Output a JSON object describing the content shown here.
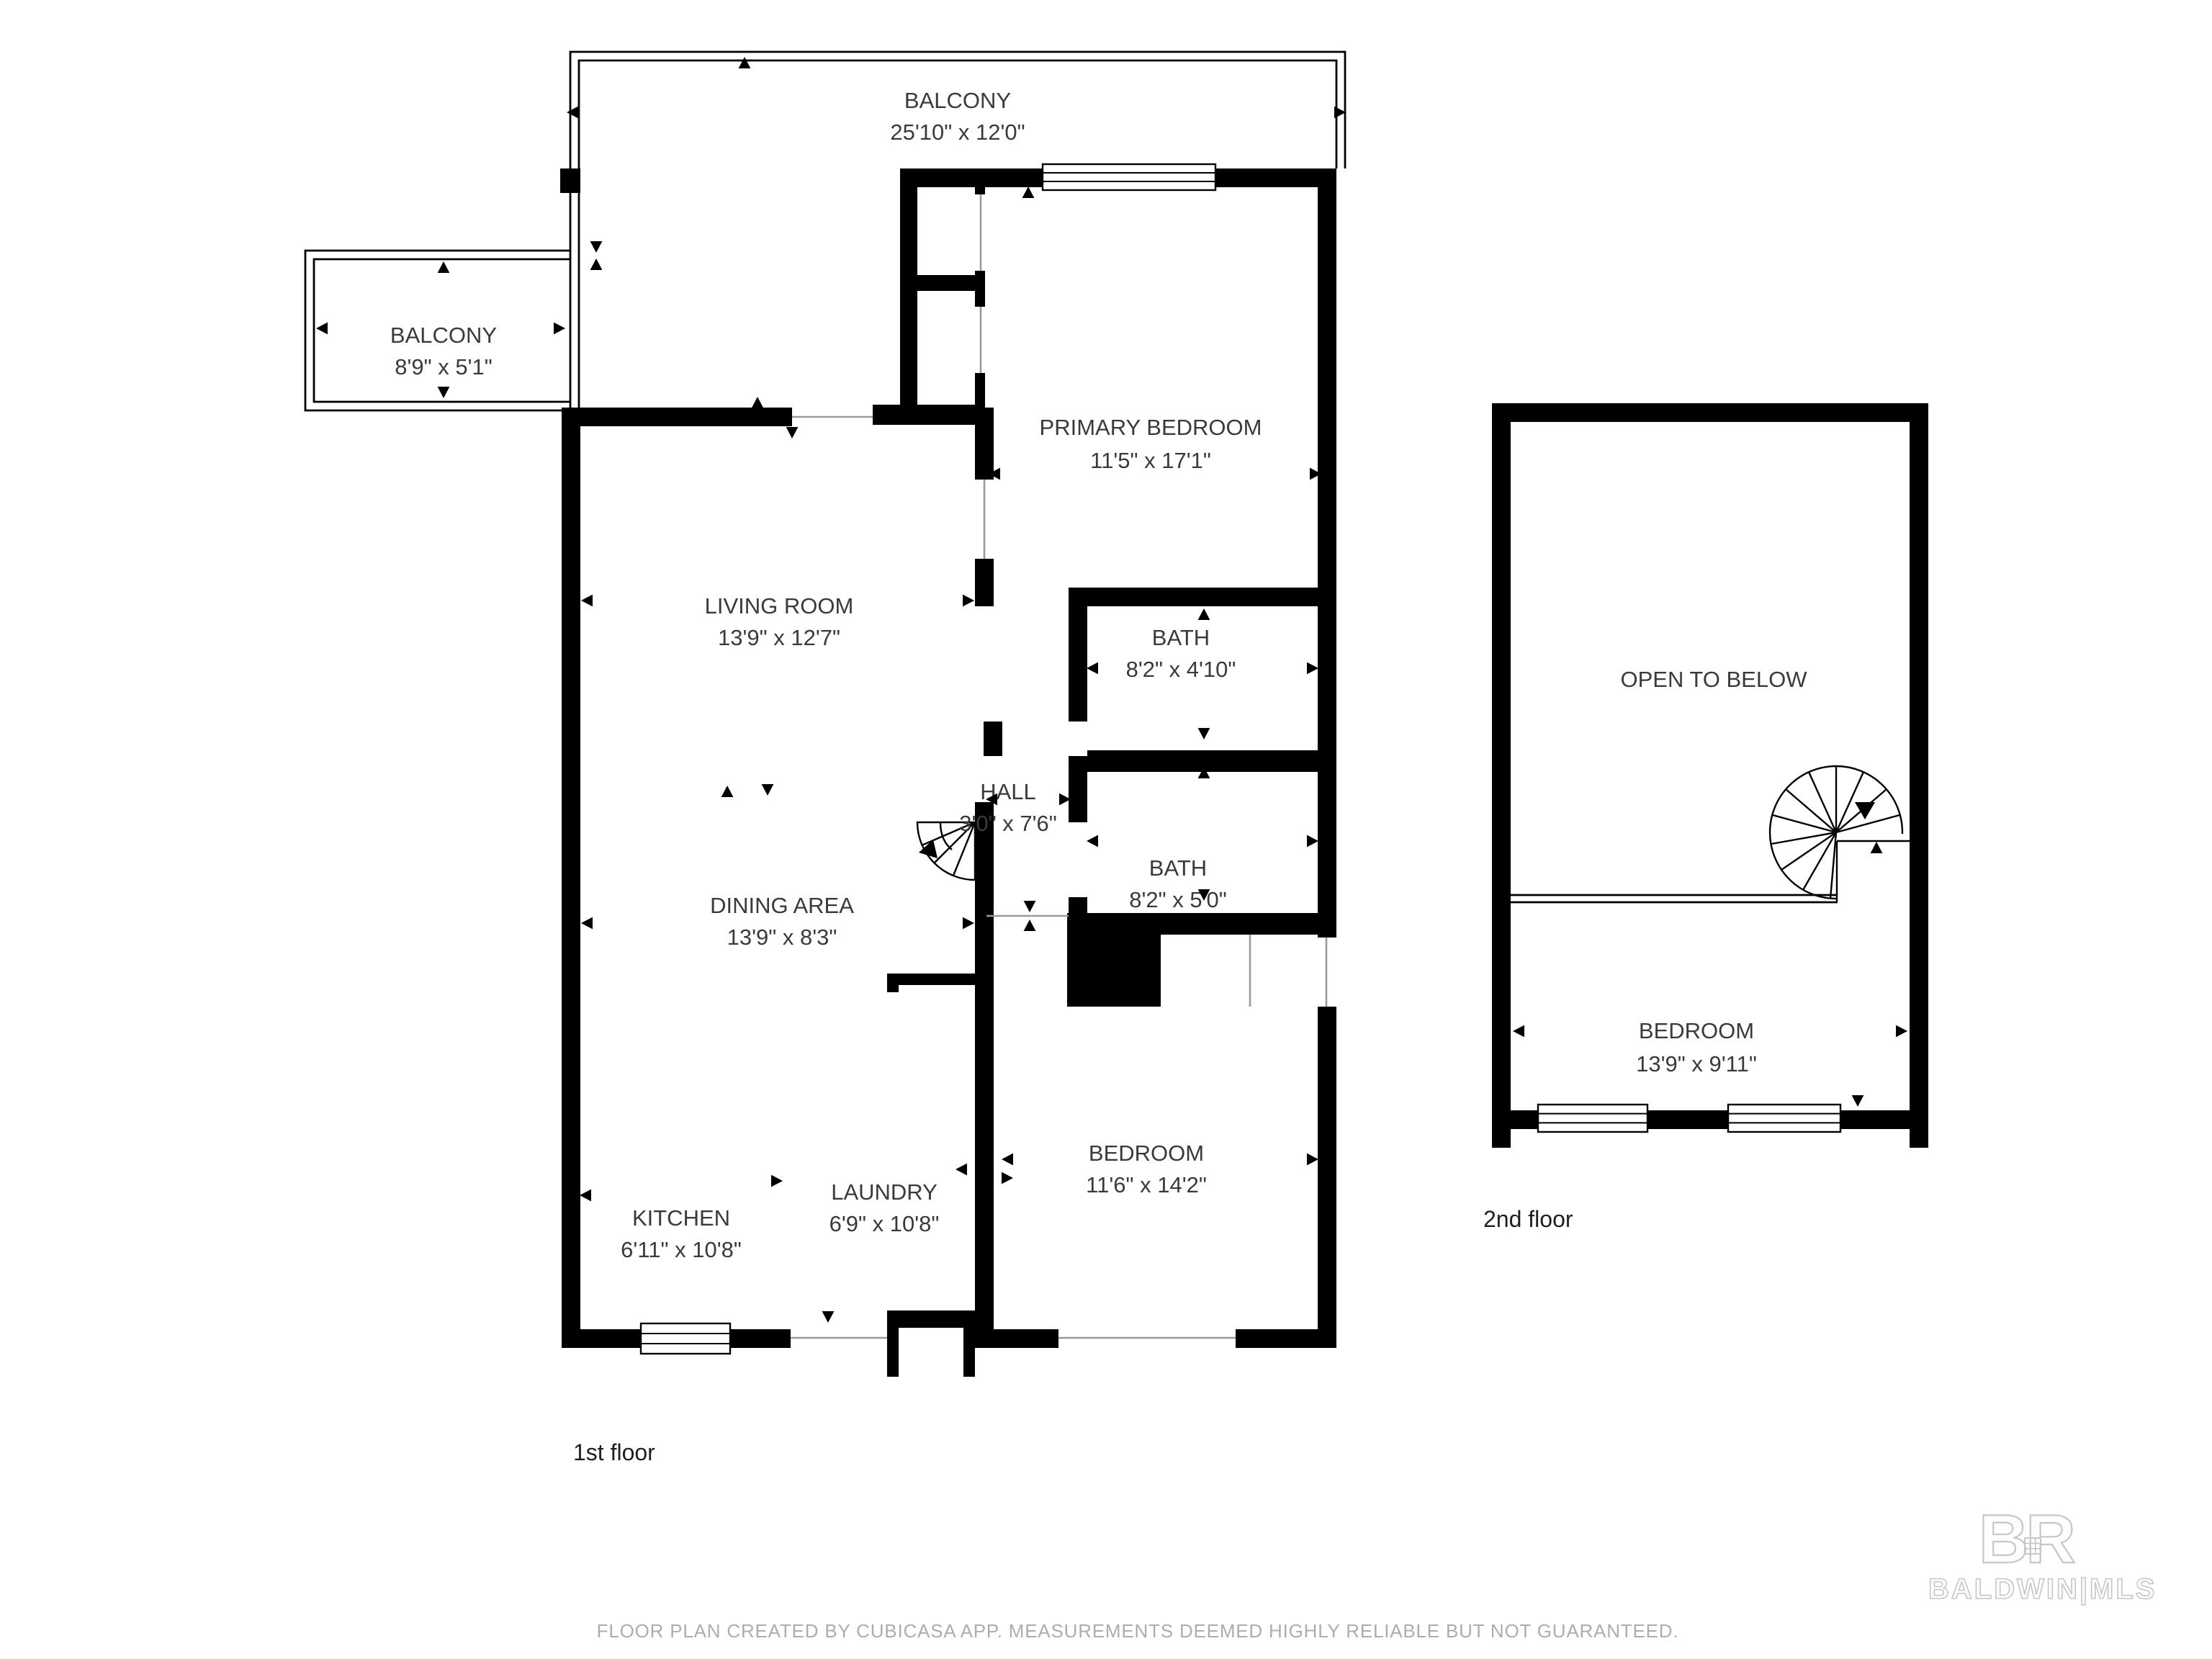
{
  "floors": [
    {
      "label": "1st floor",
      "rooms": [
        {
          "name": "BALCONY",
          "dims": "25'10\" x 12'0\""
        },
        {
          "name": "BALCONY",
          "dims": "8'9\" x 5'1\""
        },
        {
          "name": "PRIMARY BEDROOM",
          "dims": "11'5\" x 17'1\""
        },
        {
          "name": "LIVING ROOM",
          "dims": "13'9\" x 12'7\""
        },
        {
          "name": "BATH",
          "dims": "8'2\" x 4'10\""
        },
        {
          "name": "HALL",
          "dims": "3'0\" x 7'6\""
        },
        {
          "name": "BATH",
          "dims": "8'2\" x 5'0\""
        },
        {
          "name": "DINING AREA",
          "dims": "13'9\" x 8'3\""
        },
        {
          "name": "KITCHEN",
          "dims": "6'11\" x 10'8\""
        },
        {
          "name": "LAUNDRY",
          "dims": "6'9\" x 10'8\""
        },
        {
          "name": "BEDROOM",
          "dims": "11'6\" x 14'2\""
        }
      ]
    },
    {
      "label": "2nd floor",
      "rooms": [
        {
          "name": "OPEN TO BELOW"
        },
        {
          "name": "BEDROOM",
          "dims": "13'9\" x 9'11\""
        }
      ]
    }
  ],
  "footer": {
    "disclaimer": "FLOOR PLAN CREATED BY CUBICASA APP. MEASUREMENTS DEEMED HIGHLY RELIABLE BUT NOT GUARANTEED."
  },
  "logo": {
    "monogram": "BR",
    "text": "BALDWIN|MLS"
  }
}
